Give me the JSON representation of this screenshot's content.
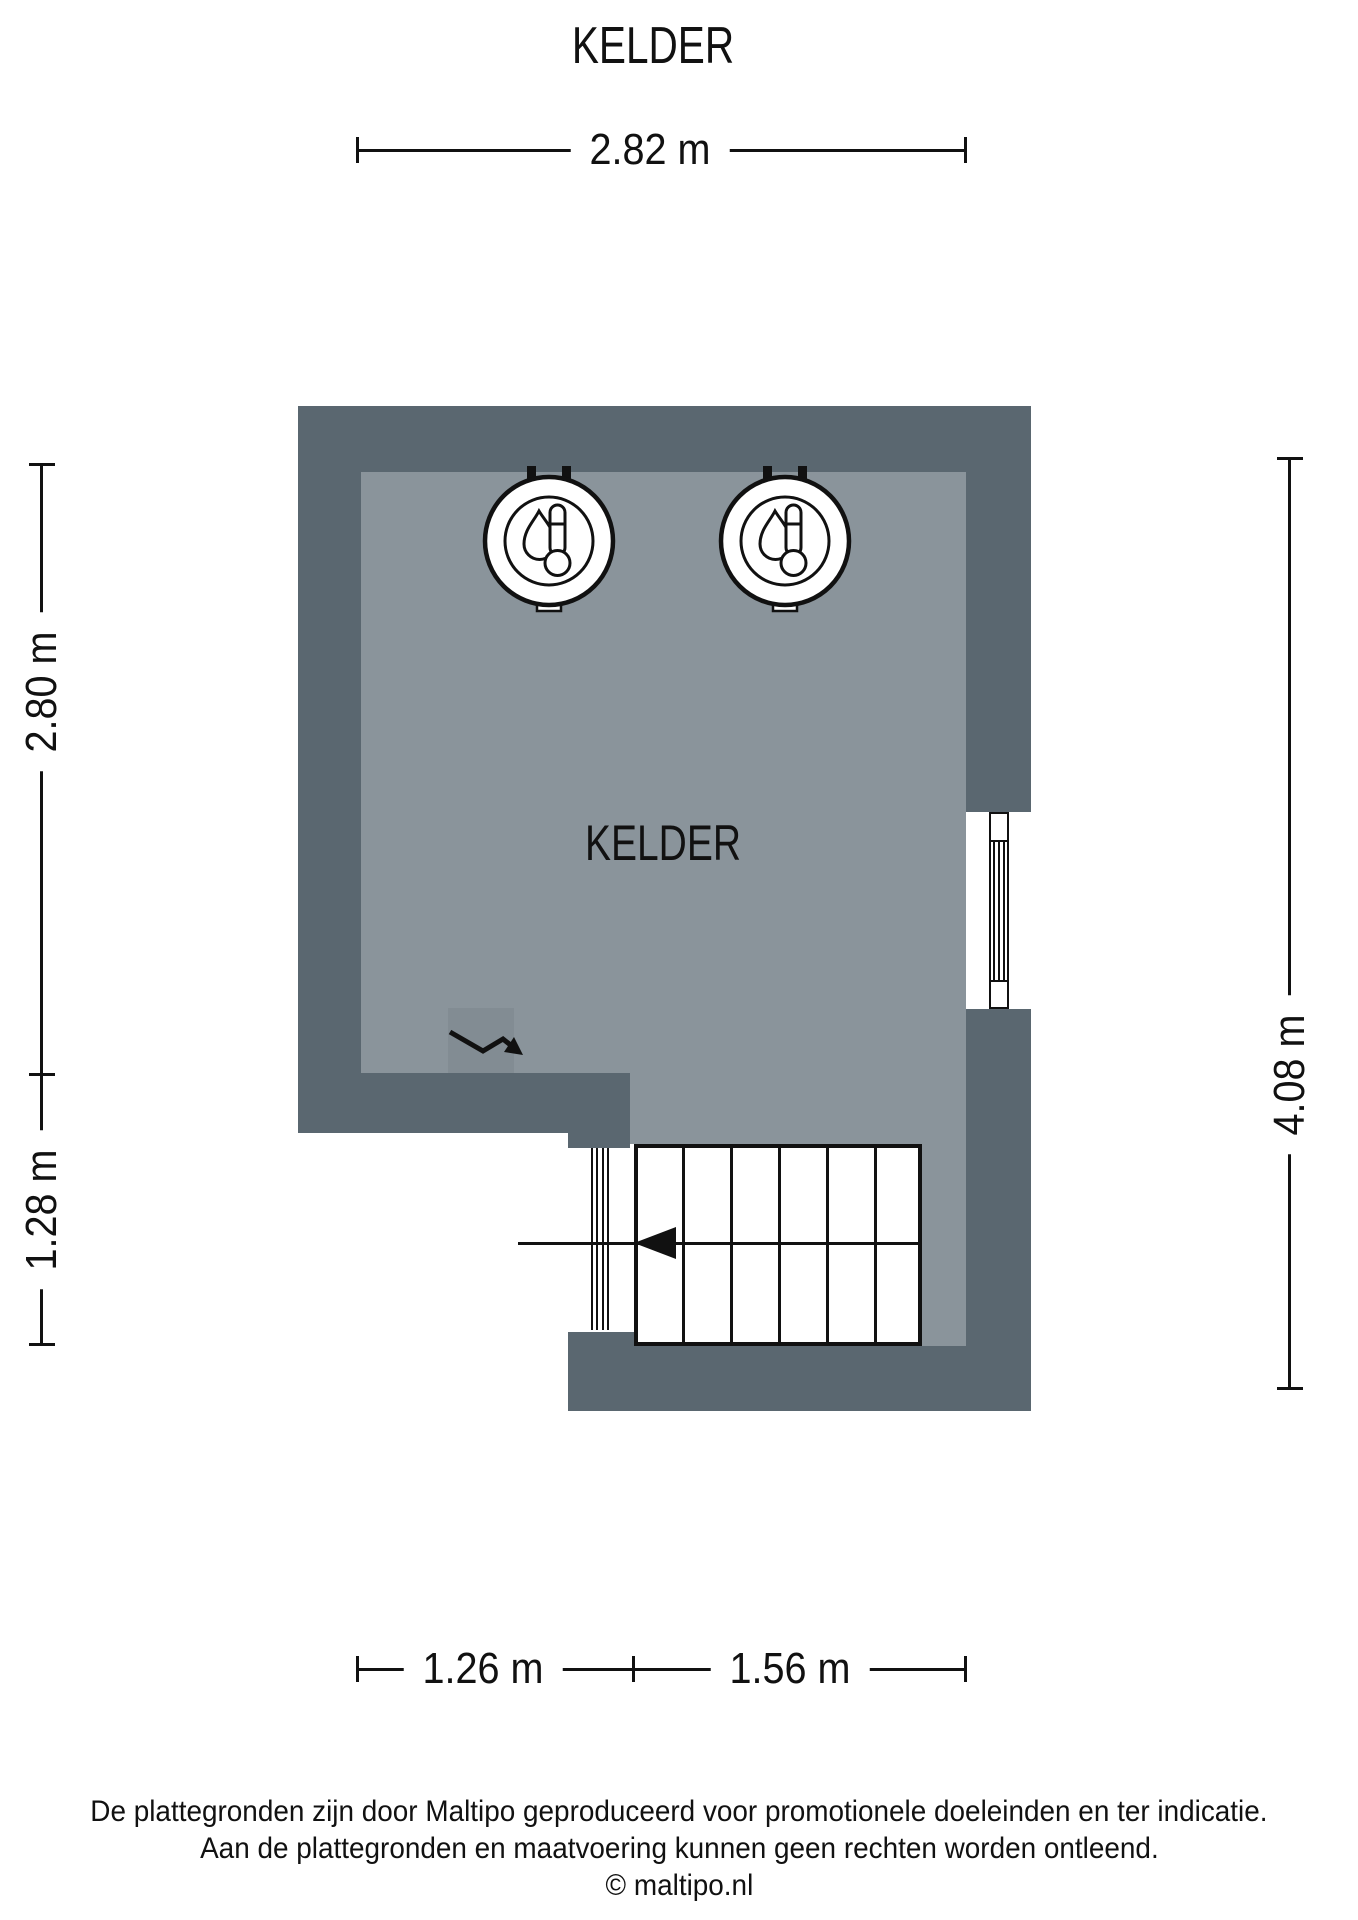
{
  "title": "KELDER",
  "room": {
    "label": "KELDER"
  },
  "dimensions": {
    "top": "2.82 m",
    "left_upper": "2.80 m",
    "left_lower": "1.28 m",
    "right": "4.08 m",
    "bottom_left": "1.26 m",
    "bottom_right": "1.56 m"
  },
  "footer": {
    "line1": "De plattegronden zijn door Maltipo geproduceerd voor promotionele doeleinden en ter indicatie.",
    "line2": "Aan de plattegronden en maatvoering kunnen geen rechten worden ontleend.",
    "line3": "© maltipo.nl"
  },
  "colors": {
    "wall": "#5A6770",
    "floor": "#8A949B"
  },
  "symbols": {
    "boiler_count": 2,
    "boiler_icon": "boiler-thermometer-icon",
    "electricity_icon": "electricity-arrow-icon",
    "window": "right-wall-window",
    "stairs_treads": 6
  }
}
